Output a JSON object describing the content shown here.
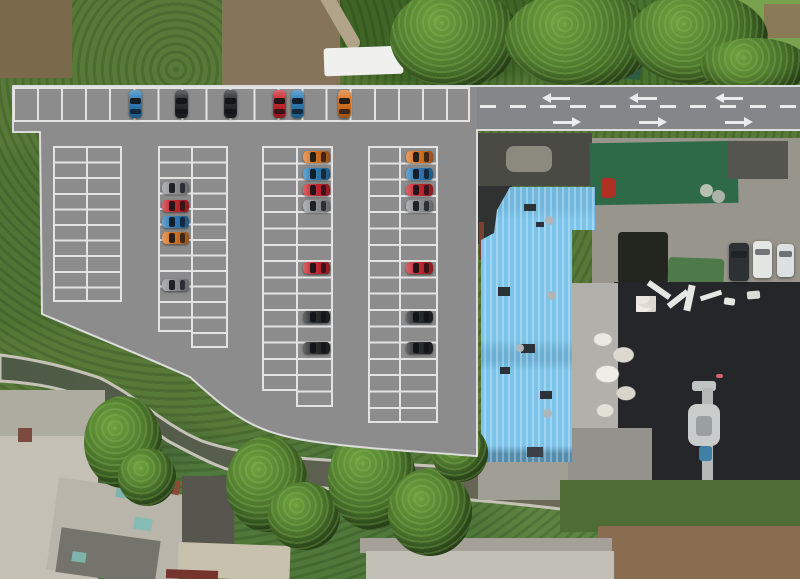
{
  "meta": {
    "description": "Aerial drone photograph with rendered parking-lot layout overlay (no visible text in image)",
    "canvas": {
      "width": 800,
      "height": 579
    }
  },
  "palette": {
    "asphalt": "#8c8c8c",
    "road_asphalt": "#84868a",
    "stall_line": "#e3e3e3",
    "curb_line": "#dcdcdc",
    "road_marking": "#ececec",
    "vegetation_base": "#587a38",
    "canal_water_dark": "#4d5a44",
    "canal_water_light": "#706b59",
    "canal_bank": "#c6c2b8",
    "blue_roof": "#7cc4ea",
    "green_roof": "#2e6a48",
    "black_roof": "#24262a",
    "concrete_yard": "#98968c",
    "car_colors": {
      "blue": "#2b7cb8",
      "red": "#c8232c",
      "orange": "#d9731f",
      "black": "#26282a",
      "gray": "#909298",
      "white": "#e4e6e4",
      "dark": "#2e3134"
    }
  },
  "road": {
    "x": 477,
    "y": 87,
    "w": 323,
    "h": 42,
    "dash_y": 105,
    "dash_x": 480,
    "dash_w": 320,
    "arrows_left": [
      [
        560,
        97
      ],
      [
        647,
        97
      ],
      [
        733,
        97
      ]
    ],
    "arrows_right": [
      [
        563,
        121
      ],
      [
        649,
        121
      ],
      [
        735,
        121
      ]
    ],
    "arrow_len": 20
  },
  "parking": {
    "top_row": {
      "x": 13,
      "y": 87,
      "w": 457,
      "h": 35,
      "stalls": 19
    },
    "columns": [
      {
        "name": "column-1",
        "x": 53,
        "y": 146,
        "left_w": 35,
        "right_w": 34,
        "left_rows": 10,
        "right_rows": 10,
        "row_h": 15.6
      },
      {
        "name": "column-2",
        "x": 158,
        "y": 146,
        "left_w": 35,
        "right_w": 35,
        "left_rows": 12,
        "right_rows": 13,
        "row_h": 15.5
      },
      {
        "name": "column-3",
        "x": 262,
        "y": 146,
        "left_w": 36,
        "right_w": 35,
        "left_rows": 15,
        "right_rows": 16,
        "row_h": 16.3
      },
      {
        "name": "column-4",
        "x": 368,
        "y": 146,
        "left_w": 33,
        "right_w": 37,
        "left_rows": 17,
        "right_rows": 17,
        "row_h": 16.3
      }
    ]
  },
  "cars": [
    {
      "color": "blue",
      "x": 135,
      "y": 104,
      "dir": "v"
    },
    {
      "color": "black",
      "x": 181,
      "y": 104,
      "dir": "v"
    },
    {
      "color": "black",
      "x": 230,
      "y": 104,
      "dir": "v"
    },
    {
      "color": "red",
      "x": 279,
      "y": 104,
      "dir": "v"
    },
    {
      "color": "blue",
      "x": 297,
      "y": 104,
      "dir": "v"
    },
    {
      "color": "orange",
      "x": 344,
      "y": 104,
      "dir": "v"
    },
    {
      "color": "gray",
      "x": 175,
      "y": 188,
      "dir": "h"
    },
    {
      "color": "red",
      "x": 175,
      "y": 206,
      "dir": "h"
    },
    {
      "color": "blue",
      "x": 175,
      "y": 222,
      "dir": "h"
    },
    {
      "color": "orange",
      "x": 175,
      "y": 238,
      "dir": "h"
    },
    {
      "color": "gray",
      "x": 175,
      "y": 285,
      "dir": "h"
    },
    {
      "color": "orange",
      "x": 316,
      "y": 157,
      "dir": "h"
    },
    {
      "color": "blue",
      "x": 316,
      "y": 174,
      "dir": "h"
    },
    {
      "color": "red",
      "x": 316,
      "y": 190,
      "dir": "h"
    },
    {
      "color": "gray",
      "x": 316,
      "y": 206,
      "dir": "h"
    },
    {
      "color": "red",
      "x": 316,
      "y": 268,
      "dir": "h"
    },
    {
      "color": "black",
      "x": 316,
      "y": 317,
      "dir": "h"
    },
    {
      "color": "black",
      "x": 316,
      "y": 348,
      "dir": "h"
    },
    {
      "color": "orange",
      "x": 419,
      "y": 157,
      "dir": "h"
    },
    {
      "color": "blue",
      "x": 419,
      "y": 174,
      "dir": "h"
    },
    {
      "color": "red",
      "x": 419,
      "y": 190,
      "dir": "h"
    },
    {
      "color": "gray",
      "x": 419,
      "y": 206,
      "dir": "h"
    },
    {
      "color": "red",
      "x": 419,
      "y": 268,
      "dir": "h"
    },
    {
      "color": "black",
      "x": 419,
      "y": 317,
      "dir": "h"
    },
    {
      "color": "black",
      "x": 419,
      "y": 348,
      "dir": "h"
    }
  ],
  "photo_vehicles": [
    {
      "name": "dark-suv",
      "x": 739,
      "y": 262,
      "w": 20,
      "h": 38,
      "color": "#2e3134"
    },
    {
      "name": "white-van",
      "x": 762,
      "y": 259,
      "w": 19,
      "h": 37,
      "color": "#e4e6e4"
    },
    {
      "name": "white-car",
      "x": 785,
      "y": 260,
      "w": 17,
      "h": 33,
      "color": "#dde0e0"
    }
  ],
  "features": [
    {
      "name": "dirt-patch-top-left",
      "x": 0,
      "y": 0,
      "w": 72,
      "h": 78,
      "color": "#7b6a4c",
      "tex": "mottle"
    },
    {
      "name": "dirt-patch-top-mid",
      "x": 222,
      "y": 0,
      "w": 118,
      "h": 88,
      "color": "#85735a",
      "tex": "mottle"
    },
    {
      "name": "dirt-trail",
      "x": 295,
      "y": 6,
      "w": 82,
      "h": 14,
      "color": "#b2a489",
      "rot": 60,
      "rad": "7px"
    },
    {
      "name": "white-container-roof",
      "x": 324,
      "y": 47,
      "w": 79,
      "h": 28,
      "color": "#f0f0ee",
      "rot": -2,
      "rad": "3px"
    },
    {
      "name": "metal-roof-top",
      "x": 602,
      "y": 42,
      "w": 40,
      "h": 36,
      "color": "#2d5c42",
      "rot": 6,
      "tex": "ribs-h"
    },
    {
      "name": "light-trees-top-right",
      "x": 726,
      "y": 0,
      "w": 74,
      "h": 58,
      "color": "#79a24e",
      "tex": "foliage"
    },
    {
      "name": "brown-patch-top-right",
      "x": 764,
      "y": 4,
      "w": 36,
      "h": 34,
      "color": "#8a7a58",
      "tex": "mottle"
    },
    {
      "name": "concrete-yard",
      "x": 592,
      "y": 138,
      "w": 208,
      "h": 172,
      "color": "#98968c",
      "tex": "concrete"
    },
    {
      "name": "flat-roof-dark-a",
      "x": 478,
      "y": 133,
      "w": 114,
      "h": 53,
      "color": "#4a4a45",
      "tex": "mottle-dark"
    },
    {
      "name": "roof-light-patch",
      "x": 506,
      "y": 146,
      "w": 46,
      "h": 26,
      "color": "#8b8a7e",
      "rad": "8px",
      "tex": "mottle"
    },
    {
      "name": "green-metal-roof",
      "x": 590,
      "y": 142,
      "w": 148,
      "h": 62,
      "color": "#2e6a48",
      "rot": -1,
      "tex": "ribs-h"
    },
    {
      "name": "flat-roof-dark-b",
      "x": 728,
      "y": 141,
      "w": 60,
      "h": 38,
      "color": "#54554e",
      "tex": "mottle-dark"
    },
    {
      "name": "red-equipment",
      "x": 601,
      "y": 178,
      "w": 14,
      "h": 20,
      "color": "#b03026",
      "rad": "3px"
    },
    {
      "name": "round-tank-1",
      "x": 700,
      "y": 184,
      "w": 13,
      "h": 13,
      "color": "#b9bfb2",
      "rad": "50%"
    },
    {
      "name": "round-tank-2",
      "x": 712,
      "y": 190,
      "w": 13,
      "h": 13,
      "color": "#adb3a8",
      "rad": "50%"
    },
    {
      "name": "pipe-stack",
      "x": 618,
      "y": 232,
      "w": 50,
      "h": 52,
      "color": "#23261f",
      "tex": "pipes"
    },
    {
      "name": "green-tarp-crates",
      "x": 668,
      "y": 258,
      "w": 56,
      "h": 26,
      "color": "#4e7a4a",
      "rot": 2,
      "tex": "pipes"
    },
    {
      "name": "black-roof",
      "x": 614,
      "y": 282,
      "w": 186,
      "h": 198,
      "color": "#24262a",
      "tex": "mottle-dark"
    },
    {
      "name": "roof-marking-bar-1",
      "x": 646,
      "y": 287,
      "w": 26,
      "h": 6,
      "color": "#e6e6e2",
      "rot": 35
    },
    {
      "name": "roof-marking-bar-2",
      "x": 666,
      "y": 296,
      "w": 24,
      "h": 6,
      "color": "#e6e6e2",
      "rot": -38
    },
    {
      "name": "roof-marking-bar-3",
      "x": 686,
      "y": 285,
      "w": 7,
      "h": 26,
      "color": "#e6e6e2",
      "rot": 12
    },
    {
      "name": "roof-marking-bar-4",
      "x": 700,
      "y": 293,
      "w": 22,
      "h": 5,
      "color": "#e6e6e2",
      "rot": -18
    },
    {
      "name": "roof-white-spot-1",
      "x": 724,
      "y": 298,
      "w": 11,
      "h": 7,
      "color": "#e6e6e2",
      "rot": 8,
      "rad": "2px"
    },
    {
      "name": "roof-white-spot-2",
      "x": 747,
      "y": 291,
      "w": 13,
      "h": 8,
      "color": "#dcdcd6",
      "rot": -5,
      "rad": "2px"
    },
    {
      "name": "red-speck",
      "x": 716,
      "y": 374,
      "w": 7,
      "h": 4,
      "color": "#d4606a",
      "rad": "2px"
    },
    {
      "name": "facade-building",
      "x": 560,
      "y": 283,
      "w": 58,
      "h": 198,
      "color": "#b2b0ab",
      "tex": "windows"
    },
    {
      "name": "debris-pile-small",
      "x": 636,
      "y": 296,
      "w": 20,
      "h": 16,
      "tex": "debris"
    },
    {
      "name": "debris-pile",
      "x": 590,
      "y": 328,
      "w": 58,
      "h": 96,
      "tex": "debris"
    },
    {
      "name": "chimney-elbow",
      "x": 692,
      "y": 381,
      "w": 24,
      "h": 10,
      "color": "#c0c4c2",
      "rad": "3px"
    },
    {
      "name": "chimney-pipe",
      "x": 702,
      "y": 388,
      "w": 11,
      "h": 92,
      "color": "#b4b8b6"
    },
    {
      "name": "chimney-hood",
      "x": 688,
      "y": 404,
      "w": 32,
      "h": 42,
      "color": "#c8ccca",
      "rad": "9px"
    },
    {
      "name": "chimney-core",
      "x": 696,
      "y": 416,
      "w": 16,
      "h": 20,
      "color": "#9aa0a0",
      "rad": "4px"
    },
    {
      "name": "chimney-valve-blue",
      "x": 699,
      "y": 446,
      "w": 13,
      "h": 15,
      "color": "#3f80a8",
      "rad": "3px"
    },
    {
      "name": "curved-building",
      "x": 556,
      "y": 428,
      "w": 96,
      "h": 70,
      "color": "#94928c",
      "rad": "0 0 0 42px",
      "tex": "concrete"
    },
    {
      "name": "path-below-blue-roof",
      "x": 478,
      "y": 462,
      "w": 90,
      "h": 38,
      "color": "#a19e96",
      "tex": "concrete"
    },
    {
      "name": "shadow-strip-roof-edge",
      "x": 478,
      "y": 186,
      "w": 34,
      "h": 58,
      "color": "#2f3230",
      "tex": "mottle-dark"
    },
    {
      "name": "rust-edge",
      "x": 479,
      "y": 222,
      "w": 5,
      "h": 38,
      "color": "#7a4034"
    },
    {
      "name": "blue-roof-building",
      "x": 478,
      "y": 187,
      "w": 117,
      "h": 275,
      "cls": "blue-roof"
    },
    {
      "name": "skylight-1",
      "x": 524,
      "y": 204,
      "w": 12,
      "h": 7,
      "color": "#2d3238"
    },
    {
      "name": "skylight-2",
      "x": 536,
      "y": 222,
      "w": 8,
      "h": 5,
      "color": "#2d3238"
    },
    {
      "name": "skylight-3",
      "x": 498,
      "y": 287,
      "w": 12,
      "h": 9,
      "color": "#2d3238"
    },
    {
      "name": "skylight-4",
      "x": 521,
      "y": 344,
      "w": 14,
      "h": 9,
      "color": "#2d3238"
    },
    {
      "name": "skylight-5",
      "x": 500,
      "y": 367,
      "w": 10,
      "h": 7,
      "color": "#2d3238"
    },
    {
      "name": "skylight-6",
      "x": 540,
      "y": 391,
      "w": 12,
      "h": 8,
      "color": "#2d3238"
    },
    {
      "name": "skylight-7",
      "x": 527,
      "y": 447,
      "w": 16,
      "h": 10,
      "color": "#3a4046"
    },
    {
      "name": "roof-vent-1",
      "x": 545,
      "y": 216,
      "w": 9,
      "h": 9,
      "color": "#aeb6ba",
      "rad": "50%"
    },
    {
      "name": "roof-vent-2",
      "x": 547,
      "y": 291,
      "w": 9,
      "h": 9,
      "color": "#aeb6ba",
      "rad": "50%"
    },
    {
      "name": "roof-vent-3",
      "x": 516,
      "y": 344,
      "w": 8,
      "h": 8,
      "color": "#aeb6ba",
      "rad": "50%"
    },
    {
      "name": "roof-vent-4",
      "x": 543,
      "y": 409,
      "w": 9,
      "h": 9,
      "color": "#aeb6ba",
      "rad": "50%"
    },
    {
      "name": "vegetation-band-right",
      "x": 560,
      "y": 480,
      "w": 240,
      "h": 52,
      "color": "#4e6c33",
      "tex": "foliage"
    },
    {
      "name": "dirt-field",
      "x": 598,
      "y": 526,
      "w": 202,
      "h": 53,
      "color": "#8a6d51",
      "tex": "mottle"
    },
    {
      "name": "canal-footbridge",
      "x": 395,
      "y": 440,
      "w": 10,
      "h": 30,
      "color": "#cfccc4",
      "rot": 10
    },
    {
      "name": "concrete-yard-left",
      "x": 0,
      "y": 390,
      "w": 105,
      "h": 52,
      "color": "#aeaba1",
      "tex": "concrete"
    },
    {
      "name": "building-left-a",
      "x": 0,
      "y": 436,
      "w": 98,
      "h": 143,
      "color": "#c4c0b6",
      "tex": "rooftop"
    },
    {
      "name": "building-left-b",
      "x": 52,
      "y": 486,
      "w": 132,
      "h": 93,
      "color": "#b9b5aa",
      "rot": 8,
      "tex": "rooftop"
    },
    {
      "name": "roof-dark-low",
      "x": 58,
      "y": 534,
      "w": 100,
      "h": 45,
      "color": "#74736c",
      "rot": 8,
      "tex": "mottle-dark"
    },
    {
      "name": "red-roof",
      "x": 140,
      "y": 478,
      "w": 40,
      "h": 14,
      "color": "#8e4a38",
      "rot": 10
    },
    {
      "name": "red-building-edge",
      "x": 18,
      "y": 428,
      "w": 14,
      "h": 14,
      "color": "#7c4a3e"
    },
    {
      "name": "teal-tank-1",
      "x": 116,
      "y": 487,
      "w": 16,
      "h": 11,
      "color": "#7db4ac",
      "rot": 8
    },
    {
      "name": "teal-tank-2",
      "x": 134,
      "y": 518,
      "w": 18,
      "h": 12,
      "color": "#85bcb4",
      "rot": 8
    },
    {
      "name": "teal-tank-3",
      "x": 72,
      "y": 552,
      "w": 14,
      "h": 10,
      "color": "#7db4ac",
      "rot": 8
    },
    {
      "name": "courtyard-dark",
      "x": 182,
      "y": 476,
      "w": 52,
      "h": 72,
      "color": "#57564e",
      "tex": "mottle-dark"
    },
    {
      "name": "beige-building",
      "x": 178,
      "y": 544,
      "w": 112,
      "h": 35,
      "color": "#c7c1ae",
      "rot": 2,
      "tex": "rooftop"
    },
    {
      "name": "maroon-roof-strip",
      "x": 166,
      "y": 570,
      "w": 52,
      "h": 9,
      "color": "#76342e",
      "rot": 2
    },
    {
      "name": "green-roof-small",
      "x": 288,
      "y": 508,
      "w": 24,
      "h": 28,
      "color": "#5d8a60",
      "rot": 8
    },
    {
      "name": "concrete-strip-bottom",
      "x": 360,
      "y": 538,
      "w": 252,
      "h": 15,
      "color": "#a5a198",
      "tex": "concrete"
    },
    {
      "name": "long-building-bottom",
      "x": 366,
      "y": 551,
      "w": 248,
      "h": 28,
      "color": "#c2bfb6",
      "tex": "rooftop"
    }
  ],
  "trees": [
    {
      "name": "tree-canopy",
      "x": 390,
      "y": -12,
      "w": 130,
      "h": 100
    },
    {
      "name": "tree-canopy",
      "x": 505,
      "y": -10,
      "w": 150,
      "h": 98
    },
    {
      "name": "tree-canopy",
      "x": 628,
      "y": -8,
      "w": 140,
      "h": 92
    },
    {
      "name": "tree-canopy",
      "x": 700,
      "y": 38,
      "w": 110,
      "h": 56
    },
    {
      "name": "tree-big-left",
      "x": 84,
      "y": 396,
      "w": 78,
      "h": 92
    },
    {
      "name": "tree",
      "x": 118,
      "y": 448,
      "w": 58,
      "h": 58
    },
    {
      "name": "tree",
      "x": 226,
      "y": 436,
      "w": 82,
      "h": 96
    },
    {
      "name": "tree",
      "x": 268,
      "y": 482,
      "w": 72,
      "h": 68
    },
    {
      "name": "tree",
      "x": 328,
      "y": 428,
      "w": 88,
      "h": 102
    },
    {
      "name": "tree",
      "x": 388,
      "y": 468,
      "w": 84,
      "h": 88
    },
    {
      "name": "tree",
      "x": 432,
      "y": 424,
      "w": 56,
      "h": 58
    }
  ]
}
